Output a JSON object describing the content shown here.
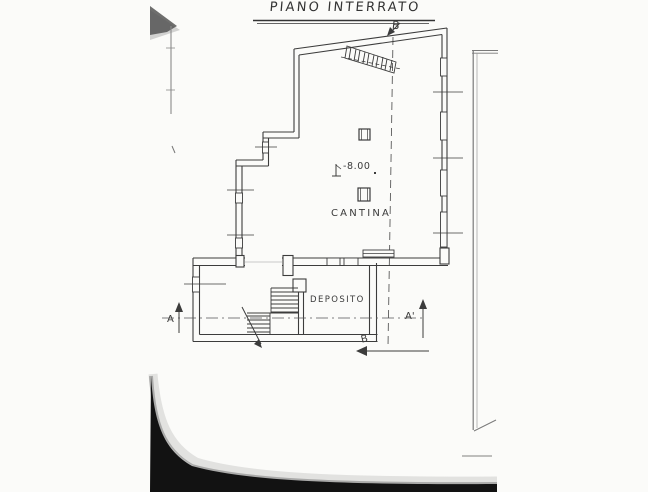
{
  "plan": {
    "title": "PIANO INTERRATO",
    "rooms": {
      "cantina": "CANTINA",
      "deposito": "DEPOSITO"
    },
    "level_mark": "-8.00",
    "markers": {
      "section_b_top": "B",
      "section_b_bottom": "B",
      "section_a_left": "A",
      "section_a_right": "A'"
    },
    "colors": {
      "ink": "#3c3c3c",
      "paper": "#fbfbf9",
      "boundary_gray": "#7a7a7a",
      "scan_shadow": "#121212"
    }
  }
}
